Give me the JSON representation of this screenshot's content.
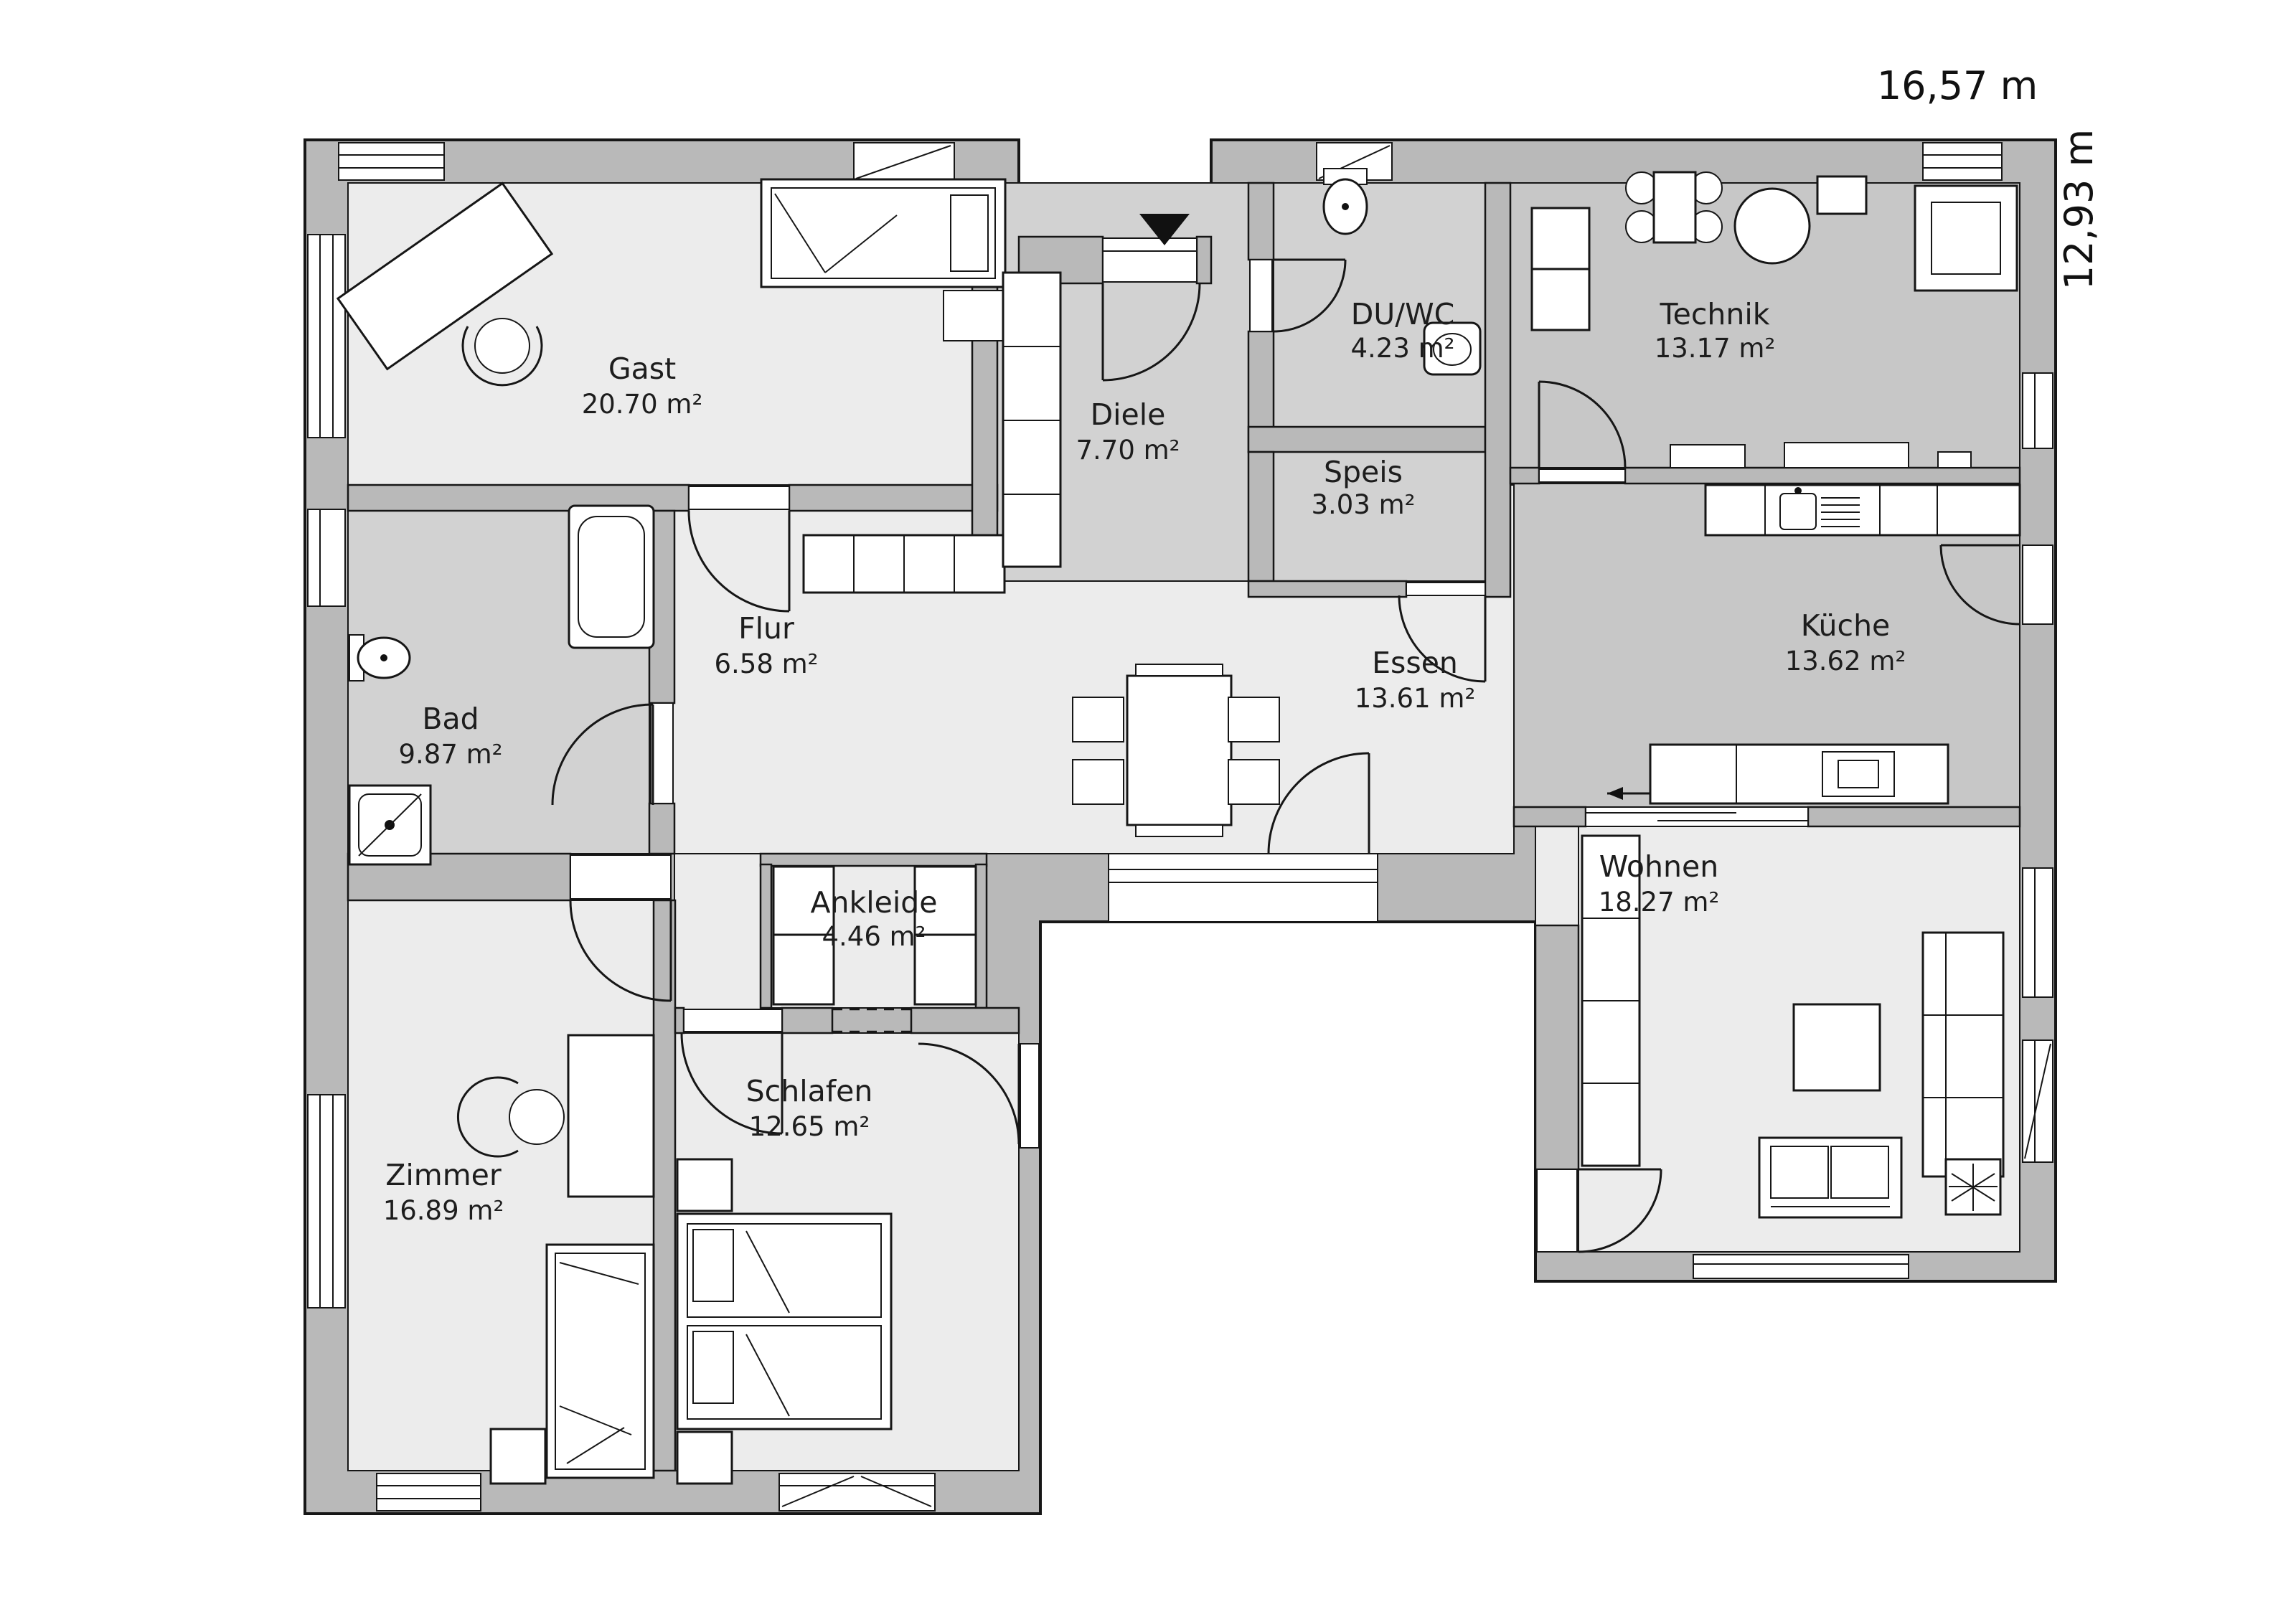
{
  "plan": {
    "type": "floor-plan",
    "dimensions": {
      "width_label": "16,57 m",
      "height_label": "12,93 m"
    },
    "rooms": [
      {
        "id": "gast",
        "name": "Gast",
        "area": "20.70 m²"
      },
      {
        "id": "diele",
        "name": "Diele",
        "area": "7.70 m²"
      },
      {
        "id": "du-wc",
        "name": "DU/WC",
        "area": "4.23 m²"
      },
      {
        "id": "technik",
        "name": "Technik",
        "area": "13.17 m²"
      },
      {
        "id": "speis",
        "name": "Speis",
        "area": "3.03 m²"
      },
      {
        "id": "flur",
        "name": "Flur",
        "area": "6.58 m²"
      },
      {
        "id": "essen",
        "name": "Essen",
        "area": "13.61 m²"
      },
      {
        "id": "kueche",
        "name": "Küche",
        "area": "13.62 m²"
      },
      {
        "id": "bad",
        "name": "Bad",
        "area": "9.87 m²"
      },
      {
        "id": "ankleide",
        "name": "Ankleide",
        "area": "4.46 m²"
      },
      {
        "id": "wohnen",
        "name": "Wohnen",
        "area": "18.27 m²"
      },
      {
        "id": "zimmer",
        "name": "Zimmer",
        "area": "16.89 m²"
      },
      {
        "id": "schlafen",
        "name": "Schlafen",
        "area": "12.65 m²"
      }
    ],
    "annotations": {
      "entrance_marker": "entrance-arrow",
      "sliding_door_arrows": [
        "←",
        "→"
      ]
    },
    "colors": {
      "wall": "#b9b9b9",
      "floor_light": "#ececec",
      "floor_mid": "#d2d2d2",
      "floor_dark": "#c7c7c7",
      "outline": "#161616",
      "background": "#ffffff"
    }
  }
}
